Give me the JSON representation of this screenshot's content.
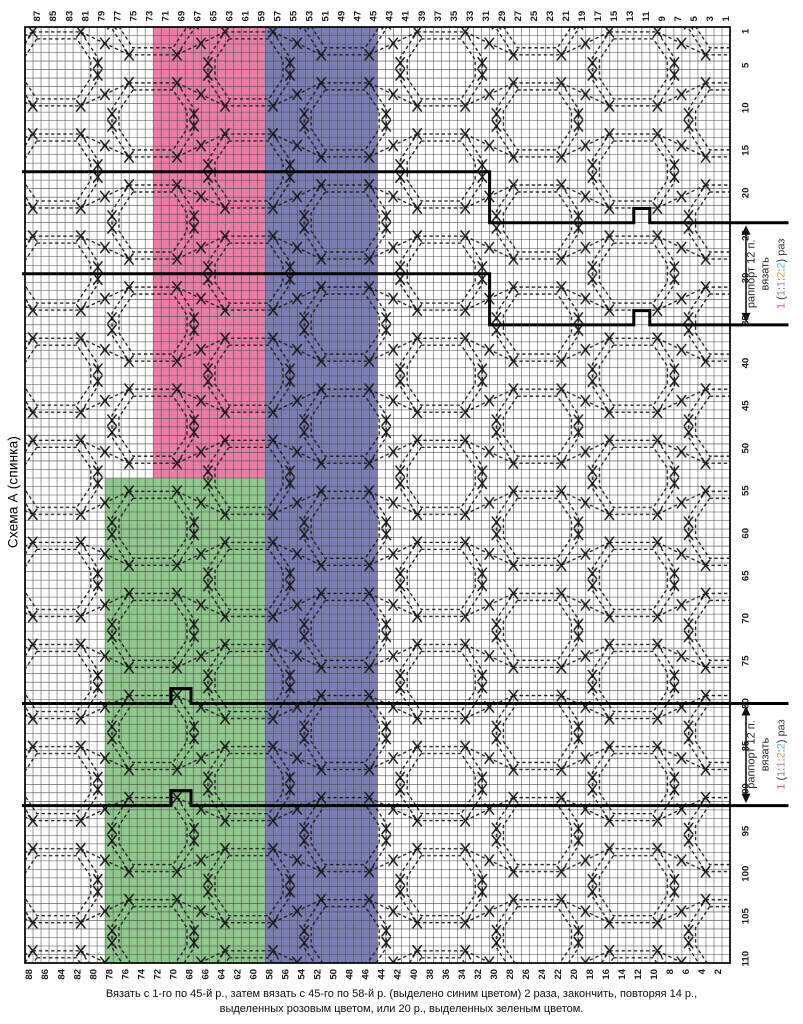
{
  "title": "Схема А (спинка)",
  "caption": {
    "line1": "Вязать с 1-го по 45-й р., затем вязать с 45-го по 58-й р. (выделено синим цветом) 2 раза, закончить, повторяя 14 р.,",
    "line2": "выделенных розовым цветом, или 20 р., выделенных зеленым цветом."
  },
  "chart_data": {
    "type": "table",
    "description": "cable knitting chart grid",
    "grid": {
      "columns": 88,
      "rows": 110
    },
    "top_axis_labels": [
      87,
      85,
      83,
      81,
      79,
      77,
      75,
      73,
      71,
      69,
      67,
      65,
      63,
      61,
      59,
      57,
      55,
      53,
      51,
      49,
      47,
      45,
      43,
      41,
      39,
      37,
      35,
      33,
      31,
      29,
      27,
      25,
      23,
      21,
      19,
      17,
      15,
      13,
      11,
      9,
      7,
      5,
      3,
      1
    ],
    "bottom_axis_labels": [
      88,
      86,
      84,
      82,
      80,
      78,
      76,
      74,
      72,
      70,
      68,
      66,
      64,
      62,
      60,
      58,
      56,
      54,
      52,
      50,
      48,
      46,
      44,
      42,
      40,
      38,
      36,
      34,
      32,
      30,
      28,
      26,
      24,
      22,
      20,
      18,
      16,
      14,
      12,
      10,
      8,
      6,
      4,
      2
    ],
    "right_axis_labels": [
      1,
      5,
      10,
      15,
      20,
      25,
      30,
      35,
      40,
      45,
      50,
      55,
      60,
      65,
      70,
      75,
      80,
      85,
      90,
      95,
      100,
      105,
      110
    ],
    "highlight_regions": [
      {
        "name": "pink-repeat-14-rows",
        "color": "#ec7da7",
        "columns_from": 59,
        "columns_to": 72,
        "rows_from": 1,
        "rows_to": 53
      },
      {
        "name": "green-repeat-20-rows",
        "color": "#8fc78d",
        "columns_from": 59,
        "columns_to": 78,
        "rows_from": 54,
        "rows_to": 110
      },
      {
        "name": "blue-rows-45-58",
        "color": "#7a7eb5",
        "columns_from": 45,
        "columns_to": 58,
        "rows_from": 1,
        "rows_to": 110
      }
    ],
    "repeat_annotations": [
      {
        "rows_from": 24,
        "rows_to": 35,
        "label_line1": "раппорт 12 п.",
        "label_line2": "вязать",
        "size_segments": [
          {
            "t": "1 ",
            "c": "#e0529b"
          },
          {
            "t": "(",
            "c": "#3c3c3c"
          },
          {
            "t": "1",
            "c": "#8f8f8f"
          },
          {
            "t": ":",
            "c": "#3c3c3c"
          },
          {
            "t": "1",
            "c": "#b48ac8"
          },
          {
            "t": ":",
            "c": "#3c3c3c"
          },
          {
            "t": "2",
            "c": "#e79b3f"
          },
          {
            "t": ":",
            "c": "#3c3c3c"
          },
          {
            "t": "2",
            "c": "#4ec2da"
          },
          {
            "t": ") раз",
            "c": "#3c3c3c"
          }
        ]
      },
      {
        "rows_from": 80,
        "rows_to": 91,
        "label_line1": "раппорт 12 п.",
        "label_line2": "вязать",
        "size_segments": [
          {
            "t": "1 ",
            "c": "#e0529b"
          },
          {
            "t": "(",
            "c": "#3c3c3c"
          },
          {
            "t": "1",
            "c": "#8f8f8f"
          },
          {
            "t": ":",
            "c": "#3c3c3c"
          },
          {
            "t": "1",
            "c": "#b48ac8"
          },
          {
            "t": ":",
            "c": "#3c3c3c"
          },
          {
            "t": "2",
            "c": "#e79b3f"
          },
          {
            "t": ":",
            "c": "#3c3c3c"
          },
          {
            "t": "2",
            "c": "#4ec2da"
          },
          {
            "t": ") раз",
            "c": "#3c3c3c"
          }
        ]
      }
    ]
  }
}
